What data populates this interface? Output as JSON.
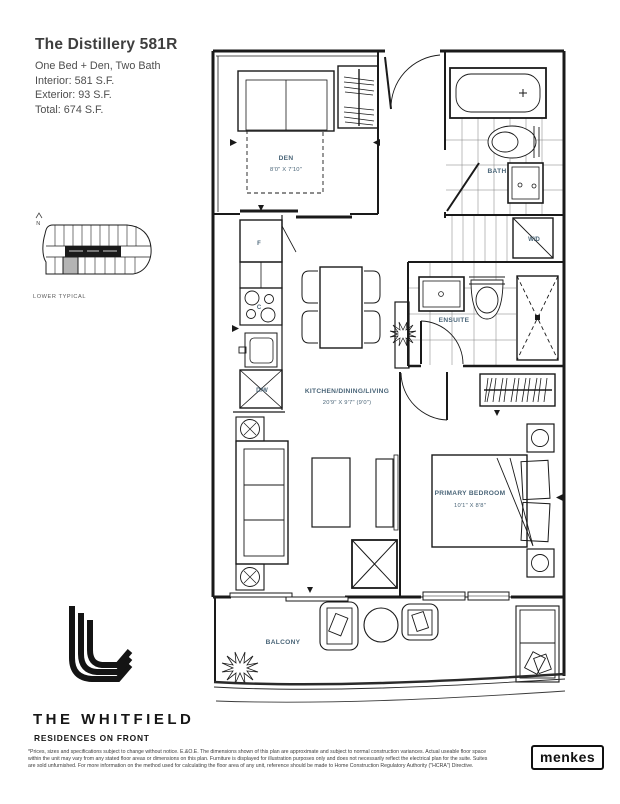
{
  "header": {
    "title": "The Distillery 581R",
    "lines": [
      "One Bed + Den, Two Bath",
      "Interior: 581 S.F.",
      "Exterior: 93 S.F.",
      "Total: 674 S.F."
    ]
  },
  "keyplan": {
    "north_label": "N",
    "caption": "LOWER TYPICAL"
  },
  "plan": {
    "rooms": {
      "den": {
        "name": "DEN",
        "dims": "8'0\" X 7'10\""
      },
      "bath": {
        "name": "BATH"
      },
      "laundry": {
        "name": "W/D"
      },
      "ensuite": {
        "name": "ENSUITE"
      },
      "kitchen": {
        "name": "KITCHEN/DINING/LIVING",
        "dims": "20'9\" X 9'7\" (9'0\")"
      },
      "bedroom": {
        "name": "PRIMARY BEDROOM",
        "dims": "10'1\" X 8'8\""
      },
      "balcony": {
        "name": "BALCONY"
      }
    },
    "appliances": {
      "fridge": "F",
      "cooktop": "C",
      "dishwasher": "D/W"
    }
  },
  "footer": {
    "brand": "THE WHITFIELD",
    "tagline": "RESIDENCES ON FRONT",
    "disclaimer_lines": [
      "*Prices, sizes and specifications subject to change without notice. E.&O.E. The dimensions shown of this plan are approximate and subject to normal construction variances. Actual useable floor space",
      "within the unit may vary from any stated floor areas or dimensions on this plan. Furniture is displayed for illustration purposes only and does not necessarily reflect the electrical plan for the suite. Suites",
      "are sold unfurnished. For more information on the method used for calculating the floor area of any unit, reference should be made to Home Construction Regulatory Authority (\"HCRA\") Directive."
    ],
    "builder": "menkes"
  },
  "colors": {
    "label": "#4a6578",
    "line": "#1a1a1a",
    "keyplan_highlight": "#b4b4b4"
  }
}
